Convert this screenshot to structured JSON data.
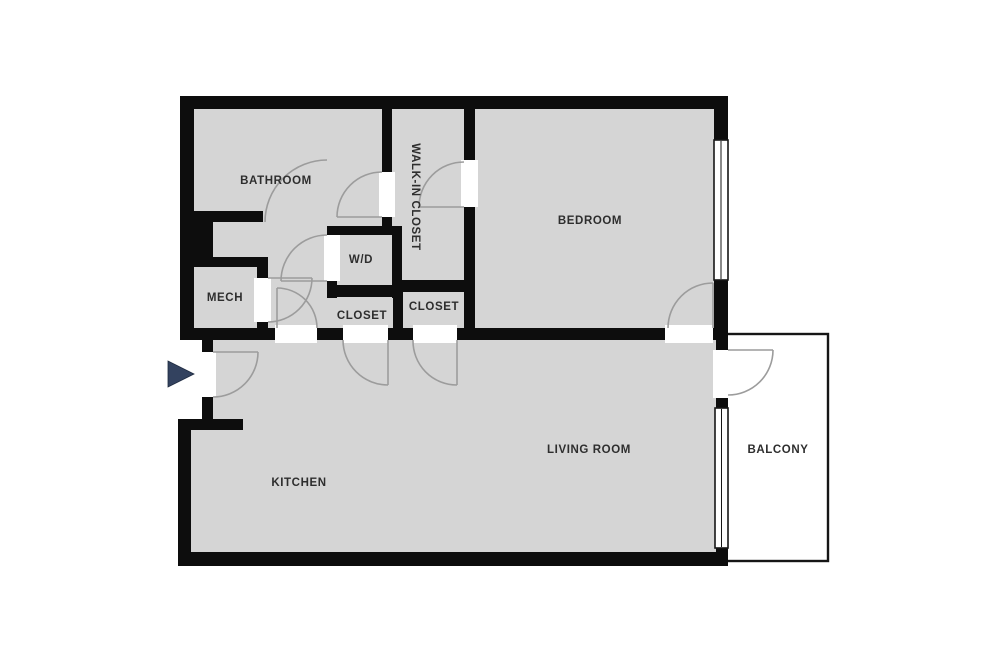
{
  "plan": {
    "type": "apartment-floor-plan",
    "rooms": [
      {
        "key": "bathroom",
        "label": "BATHROOM"
      },
      {
        "key": "walk_in_closet",
        "label": "WALK-IN CLOSET"
      },
      {
        "key": "bedroom",
        "label": "BEDROOM"
      },
      {
        "key": "wd",
        "label": "W/D"
      },
      {
        "key": "mech",
        "label": "MECH"
      },
      {
        "key": "closet_a",
        "label": "CLOSET"
      },
      {
        "key": "closet_b",
        "label": "CLOSET"
      },
      {
        "key": "kitchen",
        "label": "KITCHEN"
      },
      {
        "key": "living_room",
        "label": "LIVING ROOM"
      },
      {
        "key": "balcony",
        "label": "BALCONY"
      }
    ],
    "entry": {
      "marker": "arrow",
      "direction": "right"
    },
    "colors": {
      "wall": "#0d0d0d",
      "floor": "#d5d5d5",
      "door_swing": "#9c9c9c",
      "window_outline": "#161616",
      "balcony_outline": "#161616",
      "label_text": "#2e2e2e",
      "entry_arrow": "#33425f",
      "background": "#ffffff"
    }
  }
}
